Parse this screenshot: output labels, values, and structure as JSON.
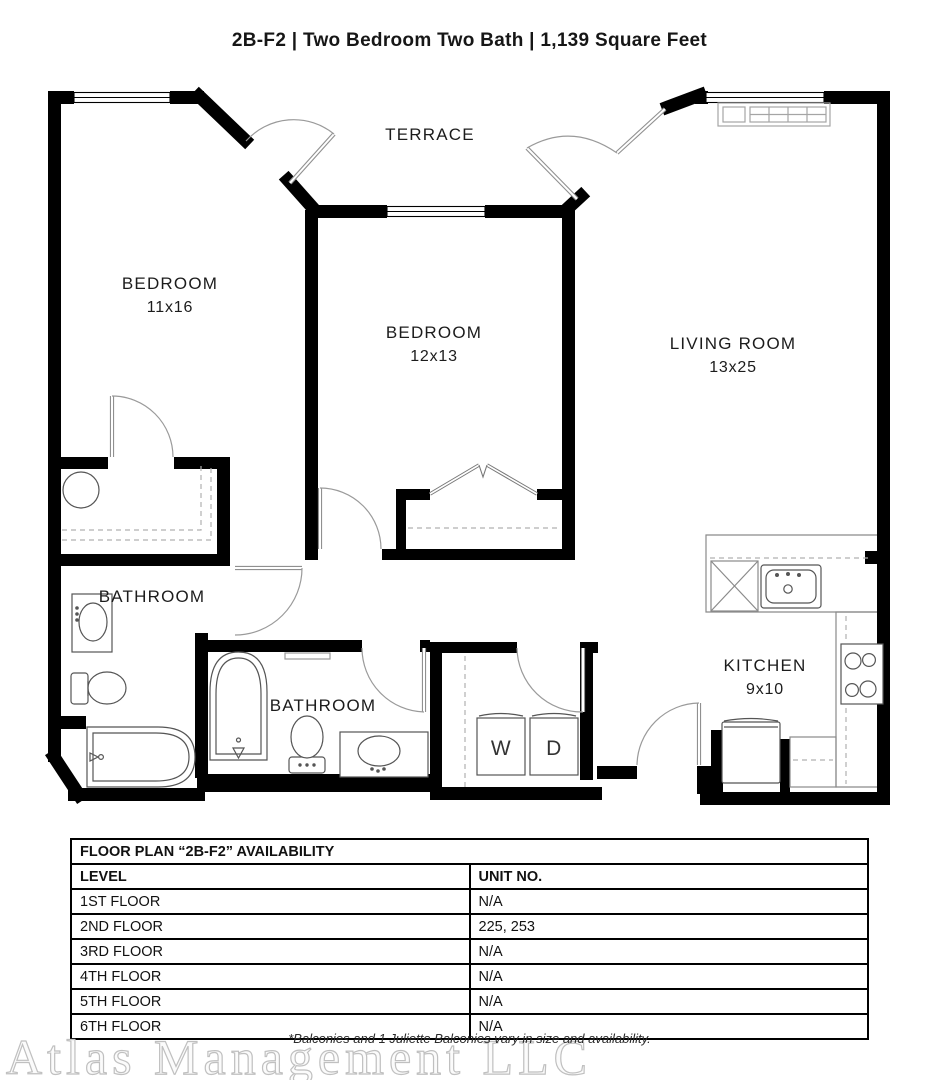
{
  "title": "2B-F2 | Two Bedroom Two Bath | 1,139 Square Feet",
  "rooms": {
    "terrace": {
      "label": "TERRACE"
    },
    "bedroom1": {
      "label": "BEDROOM",
      "dims": "11x16"
    },
    "bedroom2": {
      "label": "BEDROOM",
      "dims": "12x13"
    },
    "living": {
      "label": "LIVING ROOM",
      "dims": "13x25"
    },
    "bathroom1": {
      "label": "BATHROOM"
    },
    "bathroom2": {
      "label": "BATHROOM"
    },
    "kitchen": {
      "label": "KITCHEN",
      "dims": "9x10"
    },
    "washer": {
      "label": "W"
    },
    "dryer": {
      "label": "D"
    }
  },
  "availability_table": {
    "title": "FLOOR PLAN “2B-F2” AVAILABILITY",
    "columns": [
      "LEVEL",
      "UNIT NO."
    ],
    "rows": [
      {
        "level": "1ST FLOOR",
        "units": "N/A"
      },
      {
        "level": "2ND FLOOR",
        "units": "225, 253"
      },
      {
        "level": "3RD FLOOR",
        "units": "N/A"
      },
      {
        "level": "4TH FLOOR",
        "units": "N/A"
      },
      {
        "level": "5TH FLOOR",
        "units": "N/A"
      },
      {
        "level": "6TH FLOOR",
        "units": "N/A"
      }
    ]
  },
  "footer": {
    "watermark": "Atlas Management LLC",
    "note": "*Balconies and 1 Juliette Balconies vary in size and availability."
  },
  "colors": {
    "wall": "#000000",
    "door_line": "#909090",
    "fixture_line": "#555555",
    "cabinet_line": "#8a8a8a"
  }
}
